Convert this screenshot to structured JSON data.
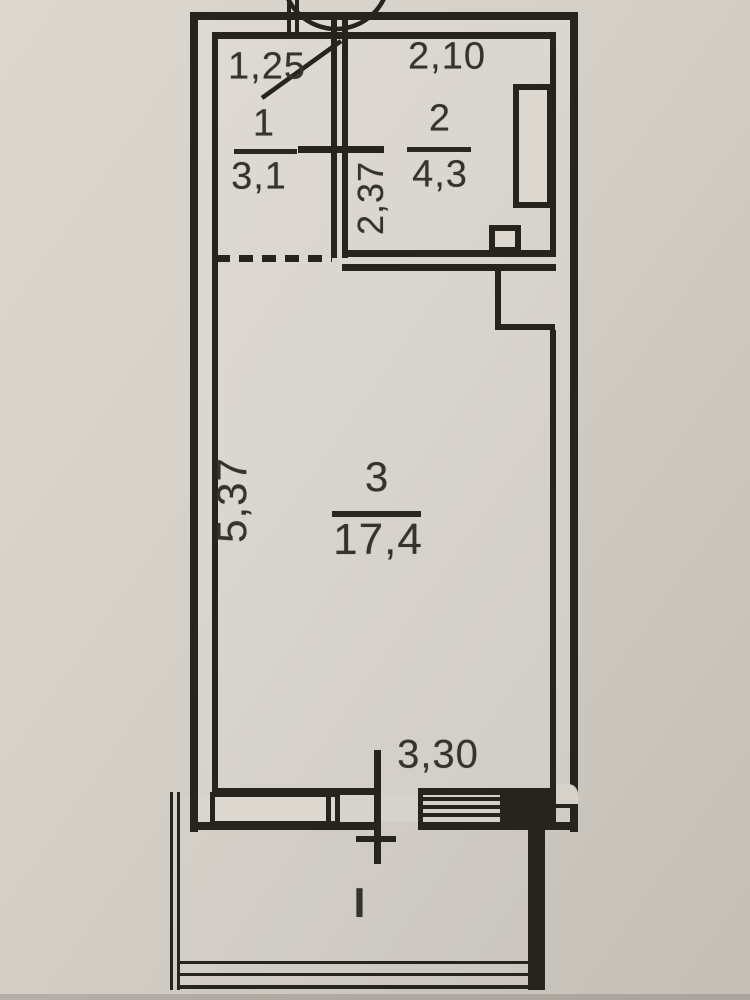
{
  "document": {
    "type": "apartment-floor-plan",
    "style": "BTI scanned plan"
  },
  "dimensions": {
    "hall_width": "1,25",
    "room2_width": "2,10",
    "room2_depth": "2,37",
    "room3_depth": "5,37",
    "room3_width": "3,30"
  },
  "rooms": [
    {
      "number": "1",
      "area": "3,1"
    },
    {
      "number": "2",
      "area": "4,3"
    },
    {
      "number": "3",
      "area": "17,4"
    }
  ],
  "axis": {
    "label": "I"
  },
  "colors": {
    "paper": "#d6d2ca",
    "paper_dark": "#c3bfb7",
    "wall_line": "#26241f",
    "ink": "#35332e"
  },
  "symbols": {
    "entrance_door": "door-swing-arc",
    "interior_door_mark": "door-cross-line",
    "opening_room3": "dashed-opening",
    "window": "window-rect",
    "balcony_door": "door-axis-line",
    "threshold": "hatched-sill",
    "balcony": "thin-outline-rect",
    "ducts": "shaft-rects"
  }
}
